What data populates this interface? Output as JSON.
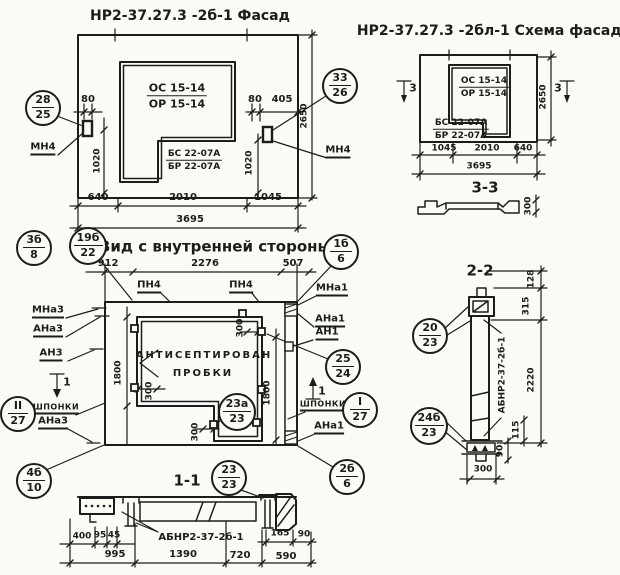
{
  "colors": {
    "ink": "#1c1c1c",
    "paper": "#fbfaf5"
  },
  "facade": {
    "title": "НР2-37.27.3 -2б-1 Фасад",
    "os": "ОС 15-14",
    "or": "ОР 15-14",
    "bs": "БС 22-07А",
    "br": "БР 22-07А",
    "mn4": "МН4",
    "c28": {
      "t": "28",
      "b": "25"
    },
    "c33": {
      "t": "33",
      "b": "26"
    },
    "d80": "80",
    "d405": "405",
    "d1020": "1020",
    "d2650": "2650",
    "d640": "640",
    "d2010": "2010",
    "d1045": "1045",
    "d3695": "3695"
  },
  "scheme": {
    "title": "НР2-37.27.3 -2бл-1 Схема фасада",
    "os": "ОС 15-14",
    "or": "ОР 15-14",
    "bs": "БС 22-07А",
    "br": "БР 22-07А",
    "marker": "3",
    "d2650": "2650",
    "d1045": "1045",
    "d2010": "2010",
    "d640": "640",
    "d3695": "3695",
    "s33_title": "3-3",
    "d300": "300"
  },
  "inner": {
    "title": "Вид с внутренней стороны",
    "note1": "АНТИСЕПТИРОВАН",
    "note2": "ПРОБКИ",
    "pn4": "ПН4",
    "mna3": "МНа3",
    "ana3": "АНа3",
    "an3": "АН3",
    "shponki": "ШПОНКИ",
    "mna1": "МНа1",
    "ana1": "АНа1",
    "an1": "АН1",
    "marker": "1",
    "d912": "912",
    "d2276": "2276",
    "d507": "507",
    "d300": "300",
    "d1800": "1800",
    "c3b": {
      "t": "3б",
      "b": "8"
    },
    "c19b": {
      "t": "19б",
      "b": "22"
    },
    "c1b": {
      "t": "1б",
      "b": "6"
    },
    "c25": {
      "t": "25",
      "b": "24"
    },
    "cI": {
      "t": "I",
      "b": "27"
    },
    "cII": {
      "t": "II",
      "b": "27"
    },
    "c4b": {
      "t": "4б",
      "b": "10"
    },
    "c2b": {
      "t": "2б",
      "b": "6"
    },
    "c23a": {
      "t": "23а",
      "b": "23"
    },
    "c23": {
      "t": "23",
      "b": "23"
    }
  },
  "s11": {
    "title": "1-1",
    "part": "АБНР2-37-2б-1",
    "d400": "400",
    "d95": "95",
    "d45": "45",
    "d165": "165",
    "d90": "90",
    "d995": "995",
    "d1390": "1390",
    "d720": "720",
    "d590": "590"
  },
  "s22": {
    "title": "2-2",
    "part": "АБНР2-37-2б-1",
    "c20": {
      "t": "20",
      "b": "23"
    },
    "c24b": {
      "t": "24б",
      "b": "23"
    },
    "d128": "128",
    "d315": "315",
    "d2220": "2220",
    "d115": "115",
    "d90": "90",
    "d300": "300"
  }
}
